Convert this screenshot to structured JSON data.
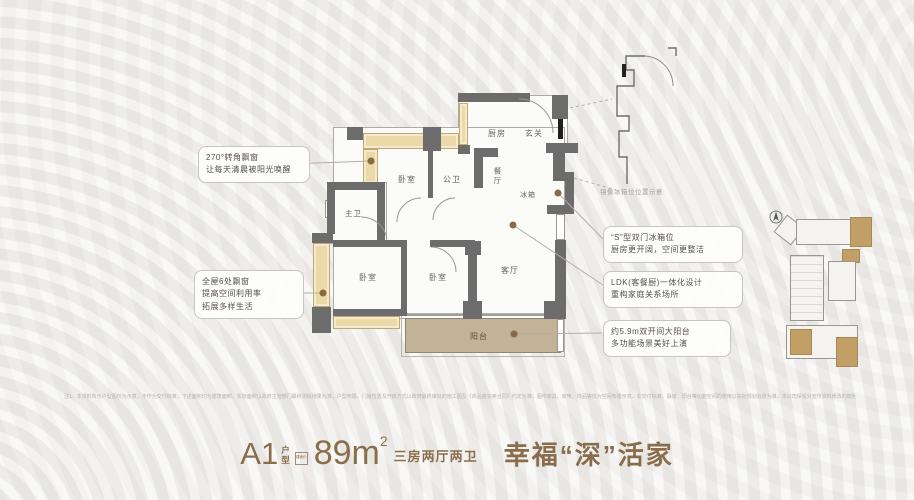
{
  "callouts": {
    "left": [
      {
        "lines": [
          "270°转角飘窗",
          "让每天清晨被阳光唤醒"
        ]
      },
      {
        "lines": [
          "全屋6处飘窗",
          "提高空间利用率",
          "拓展多样生活"
        ]
      }
    ],
    "right": [
      {
        "lines": [
          "“S”型双门冰箱位",
          "厨房更开阔，空间更整洁"
        ]
      },
      {
        "lines": [
          "LDK(客餐厨)一体化设计",
          "重构家庭关系场所"
        ]
      },
      {
        "lines": [
          "约5.9m双开间大阳台",
          "多功能场景美好上演"
        ]
      }
    ]
  },
  "floorplan": {
    "labels": {
      "kitchen": "厨房",
      "entry": "玄关",
      "bedroom_top": "卧室",
      "bath_public": "公卫",
      "dining": "餐厅",
      "fridge": "冰箱",
      "bath_master": "主卫",
      "bedroom_master": "卧室",
      "bedroom_third": "卧室",
      "living": "客厅",
      "balcony": "阳台"
    },
    "mirror_note": "镜像冰箱位位置示意"
  },
  "title": {
    "plan_code": "A1",
    "plan_char_1": "户",
    "plan_char_2": "型",
    "badge": "建面约",
    "area_value": "89m",
    "area_sup": "2",
    "layout_desc": "三房两厅两卫",
    "slogan": "幸福“深”活家"
  },
  "disclaimer": "注1：本资料所示户型图仅为示意，不作为交付标准；下述面积均为建筑面积，实际面积以政府主管部门最终测绘结果为准；户型布局、门窗位置及开启方式以政府最终审批的施工图及《商品房买卖合同》约定为准；图中家具、家电、饰品等仅为空间布置示意，非交付标准；飘窗、阳台等功能空间的使用以实际规划验收为准；本公司保留对宣传资料修改的权利，敬请留意最新资料。",
  "colors": {
    "accent": "#8a6e4b",
    "wall": "#6c6c6c",
    "bay_window": "#ecd9a9",
    "balcony": "#c3b295",
    "highlight_unit": "#c19f66"
  }
}
